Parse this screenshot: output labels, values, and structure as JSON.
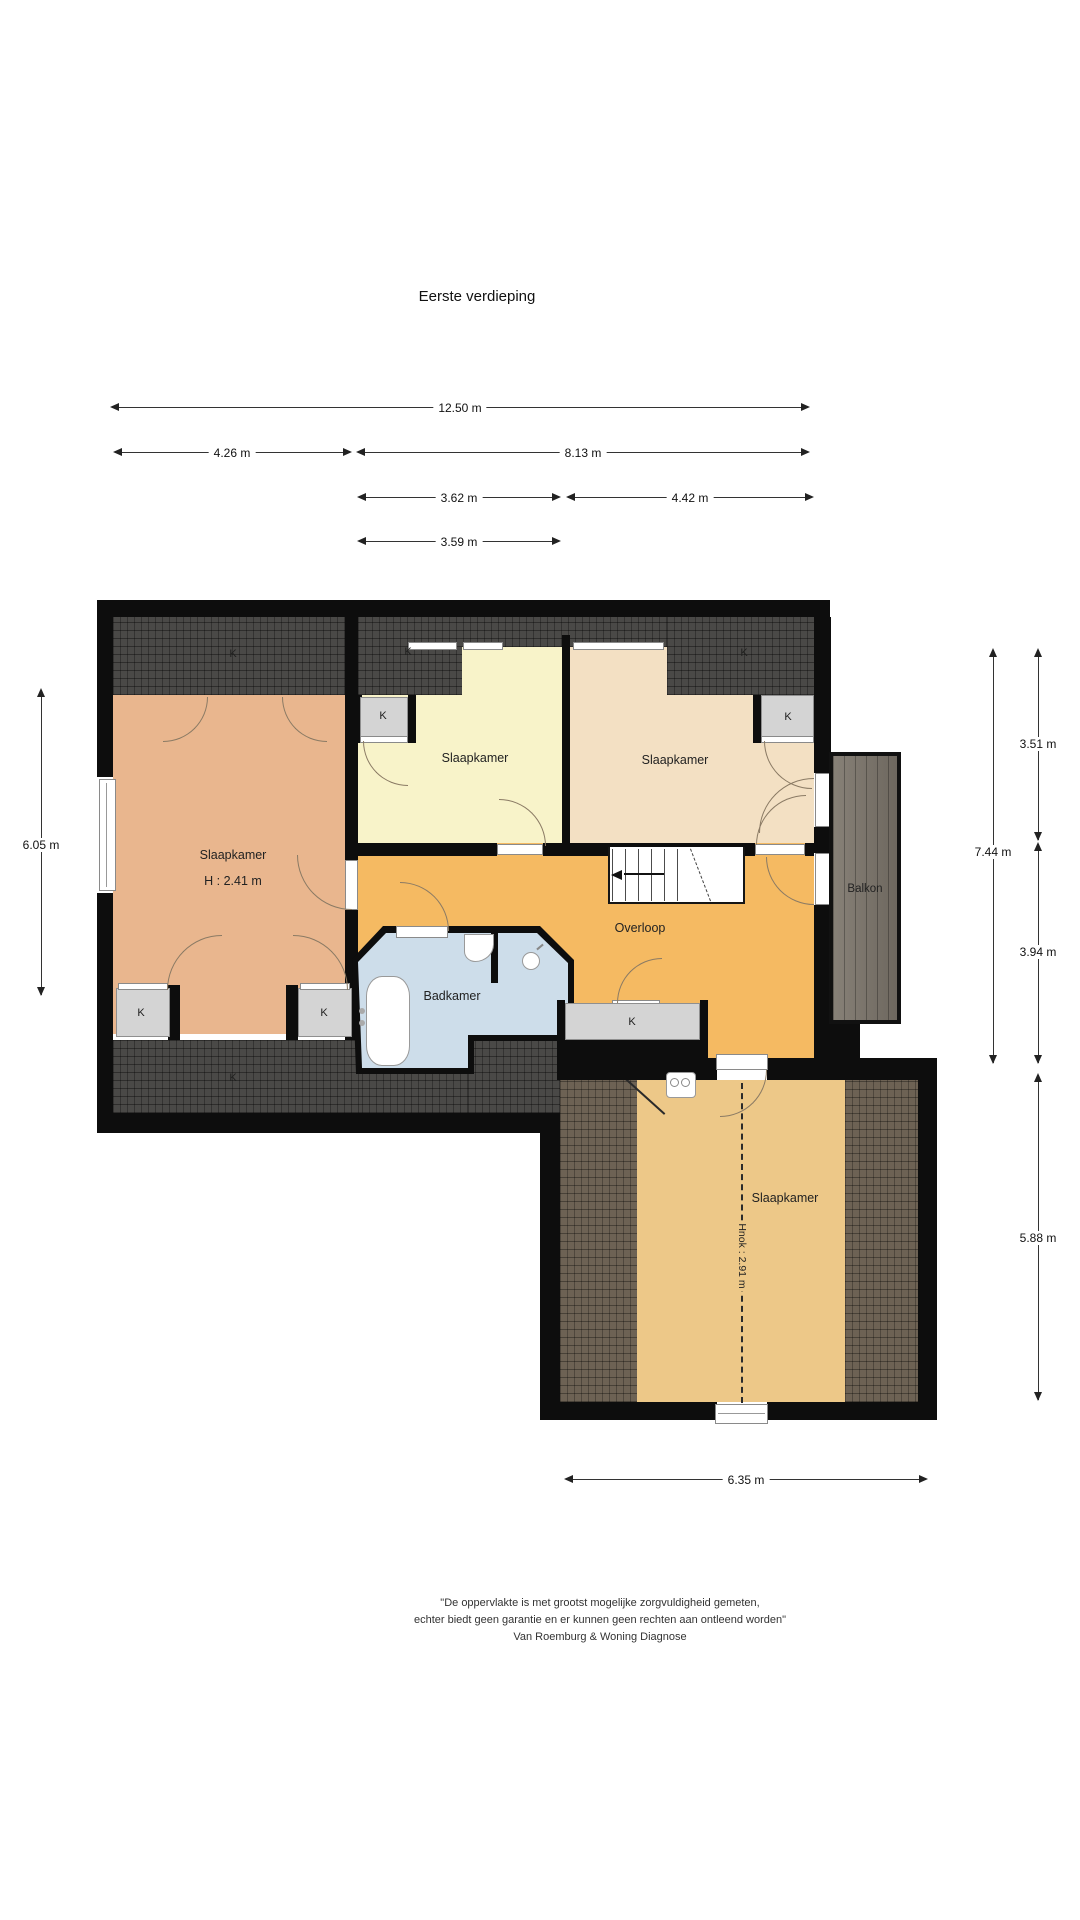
{
  "title": "Eerste verdieping",
  "rooms": {
    "bedroom_left": {
      "label": "Slaapkamer",
      "height_note": "H : 2.41 m"
    },
    "bedroom_mid": {
      "label": "Slaapkamer"
    },
    "bedroom_right": {
      "label": "Slaapkamer"
    },
    "bedroom_bottom": {
      "label": "Slaapkamer",
      "ridge_note": "Hnok : 2.91 m"
    },
    "bathroom": {
      "label": "Badkamer"
    },
    "landing": {
      "label": "Overloop"
    },
    "balcony": {
      "label": "Balkon"
    }
  },
  "labels": {
    "closet": "K"
  },
  "dimensions": {
    "top_total": "12.50 m",
    "top_left": "4.26 m",
    "top_right": "8.13 m",
    "mid_left": "3.62 m",
    "mid_right": "4.42 m",
    "small": "3.59 m",
    "left_height": "6.05 m",
    "right_total": "7.44 m",
    "right_upper": "3.51 m",
    "right_lower": "3.94 m",
    "bottom_height": "5.88 m",
    "bottom_width": "6.35 m"
  },
  "disclaimer": {
    "line1": "\"De oppervlakte is met grootst mogelijke zorgvuldigheid gemeten,",
    "line2": "echter biedt geen garantie en er kunnen geen rechten aan ontleend worden\"",
    "line3": "Van Roemburg & Woning Diagnose"
  },
  "colors": {
    "wall": "#0d0d0d",
    "roof_dark": "#4a4947",
    "roof_brown": "#6d6254",
    "floor_salmon": "#e9b68e",
    "floor_yellow": "#f8f3c9",
    "floor_beige": "#f3e0c3",
    "floor_orange": "#f5ba62",
    "floor_tan": "#edc888",
    "floor_bath": "#cdddea",
    "closet_gray": "#d4d4d4",
    "balcony_wood": "#7d766c"
  }
}
